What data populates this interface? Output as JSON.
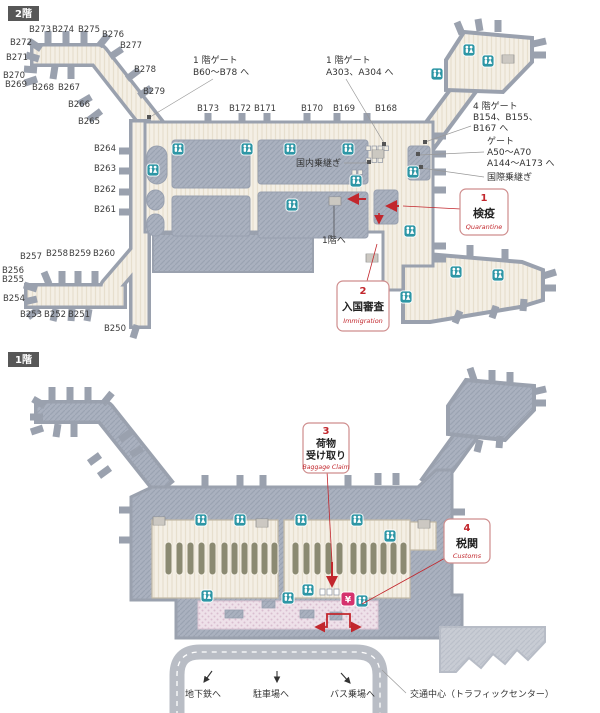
{
  "page": {
    "background": "#ffffff"
  },
  "colors": {
    "accent_red": "#c2272d",
    "restroom_teal": "#2d96a5",
    "currency_pink": "#d5326e",
    "concourse_cream": "#f4efe5",
    "structure_gray": "#a9b0be"
  },
  "floor2": {
    "badge": "2階",
    "gates": [
      "B273",
      "B274",
      "B275",
      "B276",
      "B277",
      "B272",
      "B271",
      "B270",
      "B269",
      "B268",
      "B267",
      "B278",
      "B279",
      "B266",
      "B265",
      "B264",
      "B263",
      "B262",
      "B261",
      "B257",
      "B258",
      "B259",
      "B260",
      "B256",
      "B255",
      "B254",
      "B253",
      "B252",
      "B251",
      "B250",
      "B173",
      "B172",
      "B171",
      "B170",
      "B169",
      "B168"
    ],
    "notes": {
      "gate_1f_b": [
        "1 階ゲート",
        "B60～B78 へ"
      ],
      "gate_1f_a": [
        "1 階ゲート",
        "A303、A304 へ"
      ],
      "gate_4f": [
        "4 階ゲート",
        "B154、B155、",
        "B167 へ"
      ],
      "gate_a": [
        "ゲート",
        "A50～A70",
        "A144～A173 へ"
      ],
      "intl_transfer": "国際乗継ぎ",
      "domestic_transfer": "国内乗継ぎ",
      "to_1f": "1階へ"
    },
    "checkpoints": [
      {
        "no": "1",
        "jp": "検疫",
        "en": "Quarantine"
      },
      {
        "no": "2",
        "jp": "入国審査",
        "en": "Immigration"
      }
    ]
  },
  "floor1": {
    "badge": "1階",
    "checkpoints": [
      {
        "no": "3",
        "jp_line1": "荷物",
        "jp_line2": "受け取り",
        "en": "Baggage Claim"
      },
      {
        "no": "4",
        "jp": "税関",
        "en": "Customs"
      }
    ],
    "currency_exchange_symbol": "¥",
    "exits": [
      "地下鉄へ",
      "駐車場へ",
      "バス乗場へ"
    ],
    "traffic_center": "交通中心（トラフィックセンター）"
  }
}
